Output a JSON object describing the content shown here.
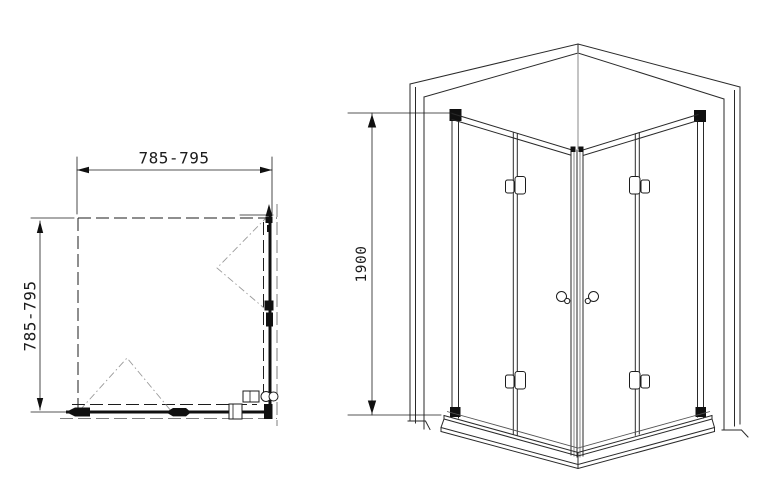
{
  "diagram": {
    "plan_view": {
      "width_label": "785-795",
      "depth_label": "785-795"
    },
    "perspective_view": {
      "height_label": "1900"
    }
  },
  "colors": {
    "background": "#ffffff",
    "line": "#1c1c1c",
    "secondary_line": "#8a8a8a",
    "swing_line": "#9a9a9a"
  }
}
